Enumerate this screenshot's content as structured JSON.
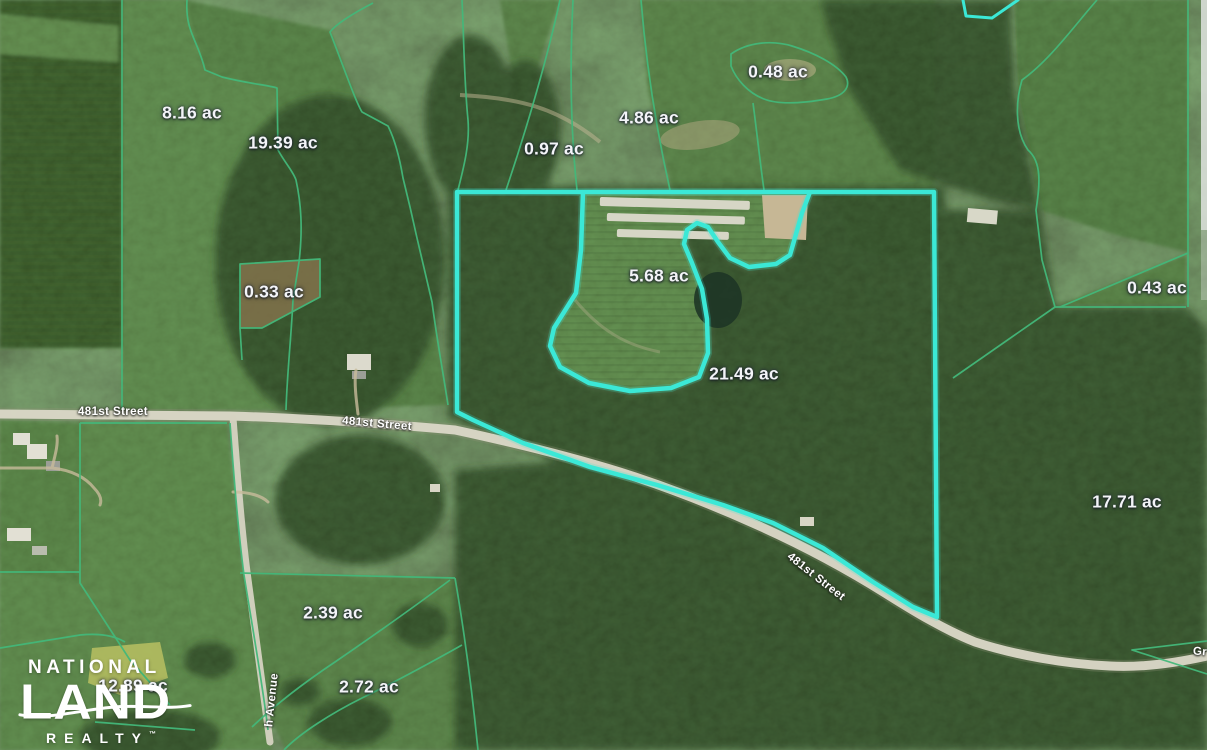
{
  "map": {
    "type": "satellite-parcel-map",
    "acreage_labels": [
      {
        "text": "8.16 ac",
        "x": 192,
        "y": 113
      },
      {
        "text": "19.39 ac",
        "x": 283,
        "y": 143
      },
      {
        "text": "0.97 ac",
        "x": 554,
        "y": 149
      },
      {
        "text": "4.86 ac",
        "x": 649,
        "y": 118
      },
      {
        "text": "0.48 ac",
        "x": 778,
        "y": 72
      },
      {
        "text": "0.33 ac",
        "x": 274,
        "y": 292
      },
      {
        "text": "5.68 ac",
        "x": 659,
        "y": 276
      },
      {
        "text": "21.49 ac",
        "x": 744,
        "y": 374
      },
      {
        "text": "0.43 ac",
        "x": 1157,
        "y": 288
      },
      {
        "text": "17.71 ac",
        "x": 1127,
        "y": 502
      },
      {
        "text": "2.39 ac",
        "x": 333,
        "y": 613
      },
      {
        "text": "2.72 ac",
        "x": 369,
        "y": 687
      },
      {
        "text": "12.89 ac",
        "x": 133,
        "y": 686
      }
    ],
    "street_labels": [
      {
        "text": "481st Street",
        "x": 113,
        "y": 412,
        "rotation": 0
      },
      {
        "text": "481st Street",
        "x": 377,
        "y": 424,
        "rotation": 5
      },
      {
        "text": "481st Street",
        "x": 816,
        "y": 577,
        "rotation": 38
      },
      {
        "text": "h Avenue",
        "x": 272,
        "y": 700,
        "rotation": -84
      },
      {
        "text": "Gr",
        "x": 1200,
        "y": 652,
        "rotation": 4
      }
    ],
    "colors": {
      "highlight_boundary": "#3BE8D6",
      "parcel_lines": "#43B87A",
      "label_text": "#F3F4F8",
      "road": "#DBD8C8"
    }
  },
  "logo": {
    "line1": "NATIONAL",
    "line2": "LAND",
    "line3": "REALTY",
    "trademark": "™"
  }
}
